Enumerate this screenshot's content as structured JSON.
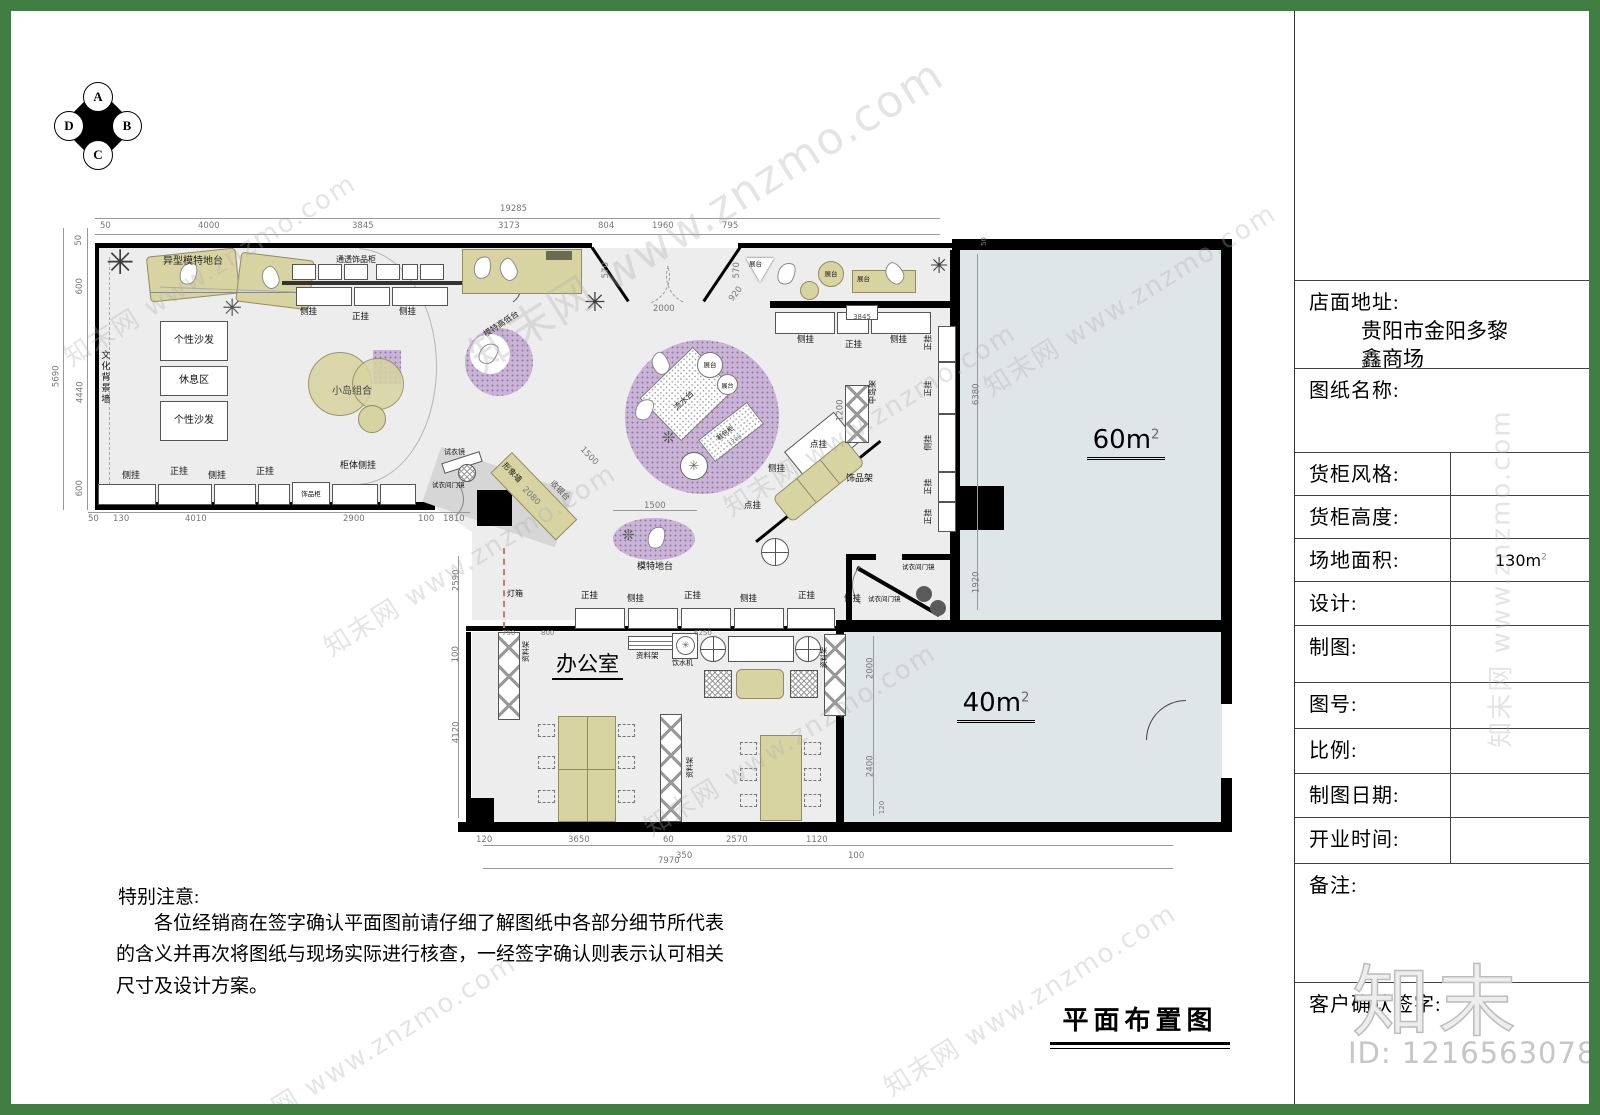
{
  "compass": {
    "n": "A",
    "e": "B",
    "s": "C",
    "w": "D"
  },
  "title_block": {
    "address_label": "店面地址:",
    "address_value": "贵阳市金阳多黎鑫商场",
    "drawing_name_label": "图纸名称:",
    "cabinet_style_label": "货柜风格:",
    "cabinet_height_label": "货柜高度:",
    "site_area_label": "场地面积:",
    "site_area_value": "130m",
    "site_area_sup": "2",
    "design_label": "设计:",
    "drafting_label": "制图:",
    "drawing_no_label": "图号:",
    "scale_label": "比例:",
    "date_label": "制图日期:",
    "opening_label": "开业时间:",
    "remarks_label": "备注:",
    "client_sign_label": "客户确认签字:"
  },
  "drawing_title": "平面布置图",
  "notes": {
    "title": "特别注意:",
    "body": "各位经销商在签字确认平面图前请仔细了解图纸中各部分细节所代表的含义并再次将图纸与现场实际进行核查，一经签字确认则表示认可相关尺寸及设计方案。"
  },
  "rooms": {
    "area60": "60m",
    "area40": "40m",
    "sup": "2",
    "office": "办公室"
  },
  "labels": {
    "special_model_stage": "异型模特地台",
    "pop_rack": "pop海报架",
    "display_cabinet": "通透饰品柜",
    "hang_side": "侧挂",
    "hang_front": "正挂",
    "hang_point": "点挂",
    "sofa": "个性沙发",
    "rest_area": "休息区",
    "culture_wall": "文化背景墙",
    "island_combo": "小岛组合",
    "model_high_low": "模特高低台",
    "jewelry_cabinet": "饰品柜",
    "cabinet_side_hang": "柜体侧挂",
    "fitting_mirror": "试衣镜",
    "fitting_door_mirror": "试衣间门镜",
    "image_wall": "形象墙",
    "cashier": "收银台",
    "light_box": "灯箱",
    "display_stand": "展台",
    "flow_table": "流水台",
    "shoe_bag_cabinet": "鞋包柜",
    "model_stage": "模特地台",
    "island_rack": "中岛架",
    "jewelry_rack": "饰品架",
    "material_rack": "资料架",
    "water_dispenser": "饮水机"
  },
  "dims": {
    "t19285": "19285",
    "d50": "50",
    "d4000": "4000",
    "d3845": "3845",
    "d3173": "3173",
    "d804": "804",
    "d1960": "1960",
    "d795": "795",
    "d570": "570",
    "d2000": "2000",
    "d920": "920",
    "d5690": "5690",
    "d600": "600",
    "d4440": "4440",
    "d130": "130",
    "d4010": "4010",
    "d2900": "2900",
    "d100": "100",
    "d1810": "1810",
    "d2590": "2590",
    "d4120": "4120",
    "d120": "120",
    "d3650": "3650",
    "d60": "60",
    "d350": "350",
    "d2570": "2570",
    "d1120": "1120",
    "d7970": "7970",
    "d6380": "6380",
    "d1920": "1920",
    "d2400": "2400",
    "d1500": "1500",
    "d2080": "2080",
    "d1200": "1200",
    "d800": "800",
    "d750": "750",
    "d6250": "6250"
  },
  "watermark": {
    "site": "知末网 www.znzmo.com",
    "logo": "知末",
    "id": "ID: 1216563078"
  }
}
